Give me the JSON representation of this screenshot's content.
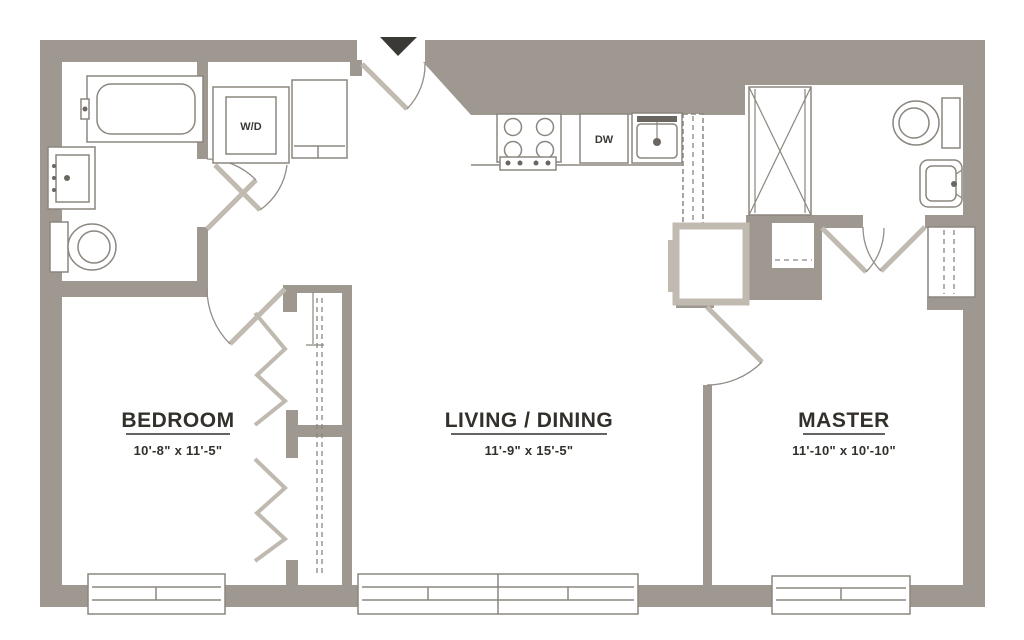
{
  "rooms": {
    "bedroom": {
      "name": "BEDROOM",
      "dims": "10'-8\" x 11'-5\""
    },
    "living": {
      "name": "LIVING / DINING",
      "dims": "11'-9\" x 15'-5\""
    },
    "master": {
      "name": "MASTER",
      "dims": "11'-10\" x 10'-10\""
    }
  },
  "appliances": {
    "washer_dryer": "W/D",
    "dishwasher": "DW"
  },
  "colors": {
    "wall": "#9e9890",
    "wall_light": "#c0bab1",
    "fixture_line": "#8b867f",
    "text": "#33302c",
    "entry_marker": "#3b3936",
    "background": "#ffffff"
  },
  "icons": {
    "entry_marker": "triangle-down-icon"
  }
}
